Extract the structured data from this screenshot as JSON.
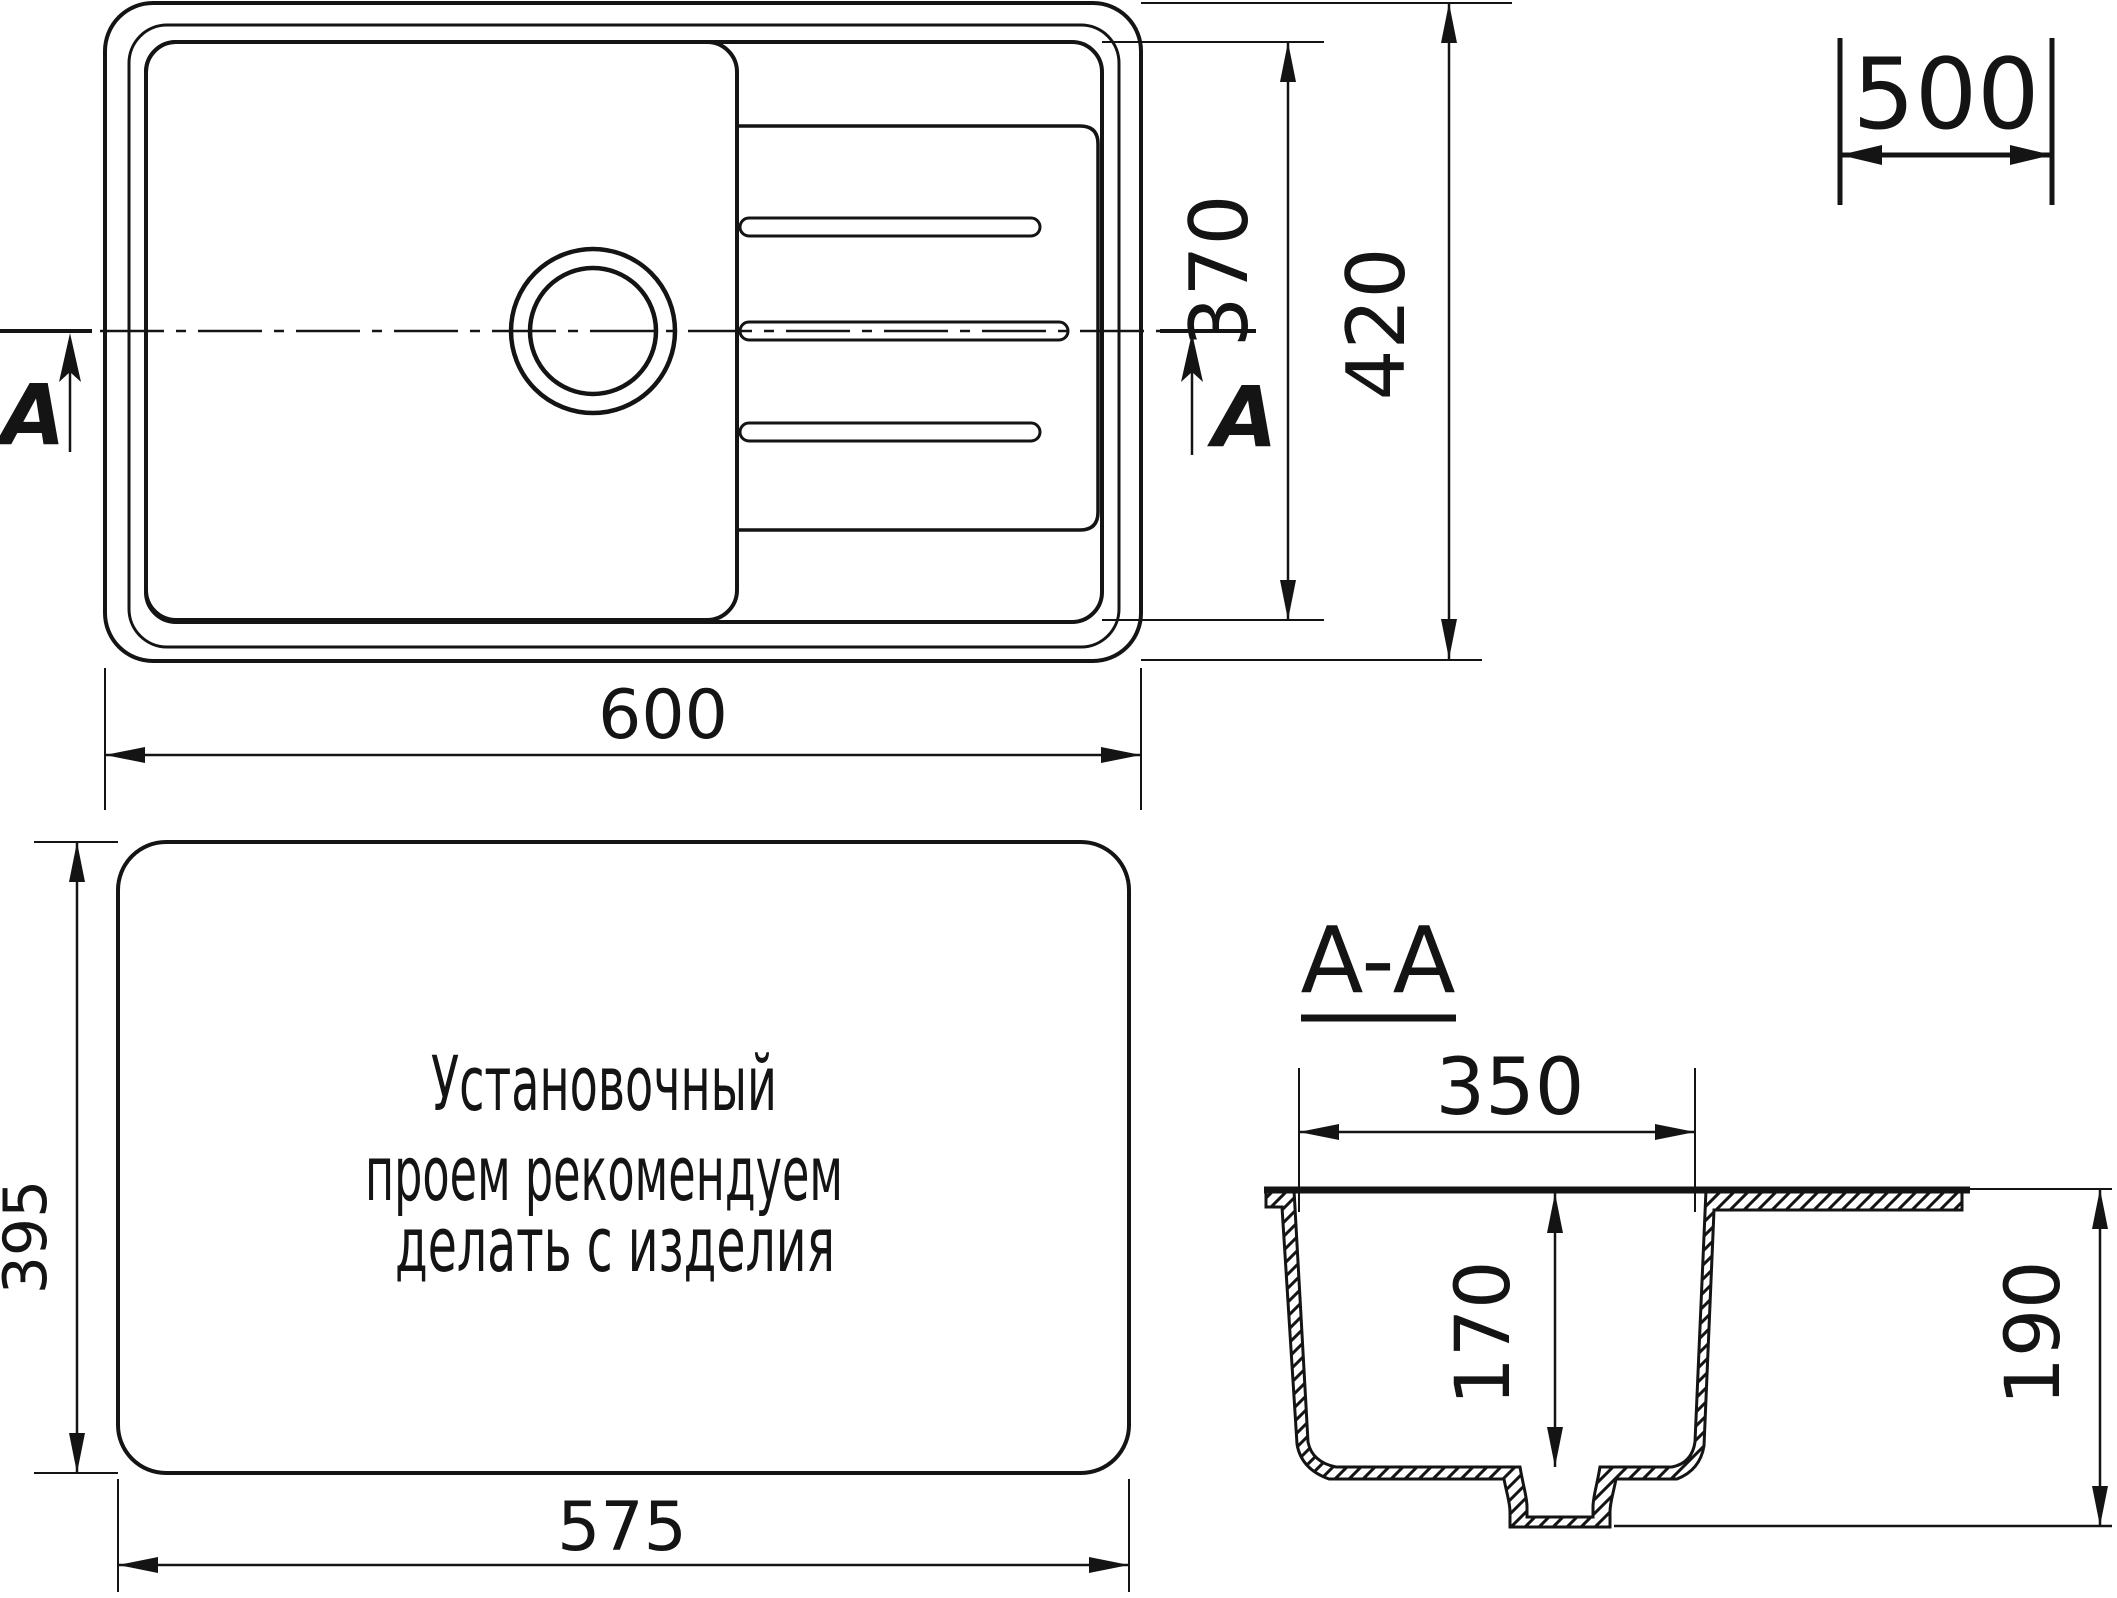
{
  "top_view": {
    "dim_width": "600",
    "dim_height": "420",
    "dim_bowl_height": "370",
    "dim_cabinet": "500",
    "section_letter_left": "A",
    "section_letter_right": "A"
  },
  "cutout_view": {
    "dim_width": "575",
    "dim_height": "395",
    "note_lines": [
      "Установочный",
      "проем рекомендуем",
      "делать с изделия"
    ]
  },
  "section_view": {
    "title": "A-A",
    "dim_bowl_width": "350",
    "dim_bowl_depth": "170",
    "dim_total_depth": "190"
  }
}
